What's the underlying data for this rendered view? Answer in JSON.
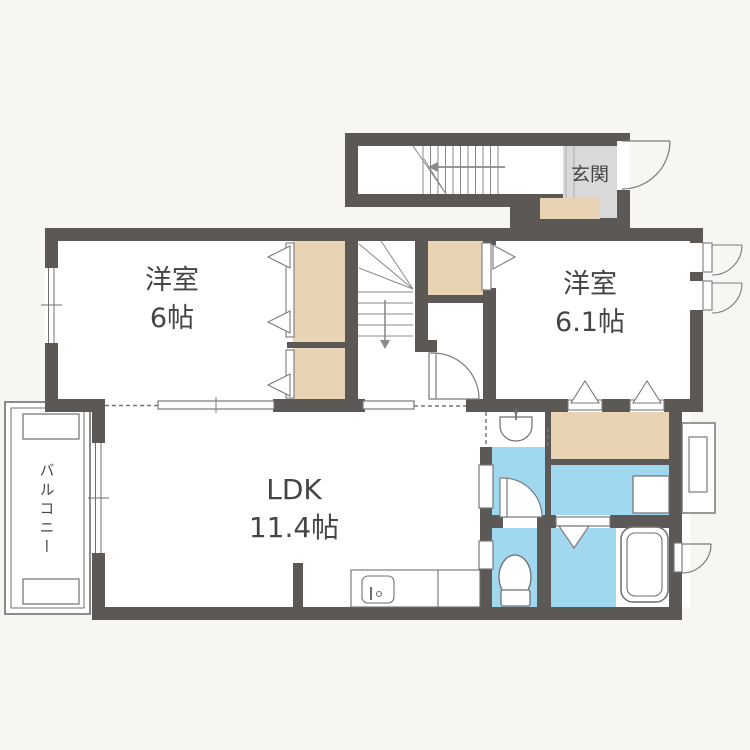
{
  "rooms": {
    "bedroom_left": {
      "name": "洋室",
      "area": "6帖"
    },
    "bedroom_right": {
      "name": "洋室",
      "area": "6.1帖"
    },
    "ldk": {
      "name": "LDK",
      "area": "11.4帖"
    },
    "entrance": {
      "name": "玄関"
    },
    "balcony": {
      "name": "バルコニー"
    }
  },
  "colors": {
    "background": "#f7f6f3",
    "wall": "#5b5855",
    "closet": "#e8d3b4",
    "water": "#a0d8f0",
    "entrance_floor": "#d9d9d9",
    "fixture_line": "#6f6f6f",
    "text": "#454545"
  }
}
